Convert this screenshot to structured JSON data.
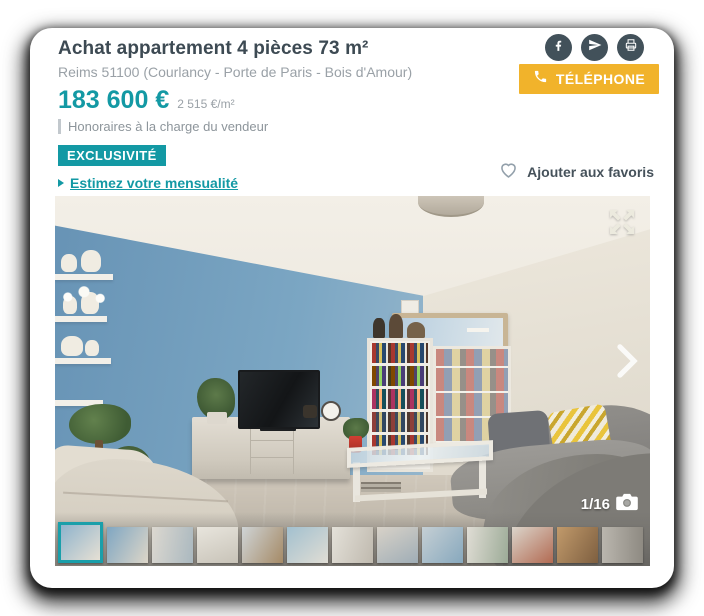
{
  "listing": {
    "title": "Achat appartement 4 pièces 73 m²",
    "location": "Reims 51100 (Courlancy - Porte de Paris - Bois d'Amour)",
    "price": "183 600 €",
    "price_per_sqm": "2 515 €/m²",
    "fees_note": "Honoraires à la charge du vendeur",
    "badge": "EXCLUSIVITÉ",
    "estimate_link": "Estimez votre mensualité",
    "phone_button": "TÉLÉPHONE",
    "favorite_label": "Ajouter aux favoris"
  },
  "share": {
    "icons": [
      "facebook",
      "send",
      "print"
    ]
  },
  "gallery": {
    "counter": "1/16",
    "selected_index": 0,
    "thumbnails": [
      {
        "angle": 135,
        "c1": "#8fb3cc",
        "c2": "#e6e0d4"
      },
      {
        "angle": 120,
        "c1": "#7fa6c2",
        "c2": "#ddd6c8"
      },
      {
        "angle": 100,
        "c1": "#dcd8d0",
        "c2": "#aab8bf"
      },
      {
        "angle": 160,
        "c1": "#e8e5dd",
        "c2": "#c8c3b8"
      },
      {
        "angle": 120,
        "c1": "#cfd4d6",
        "c2": "#a58a66"
      },
      {
        "angle": 140,
        "c1": "#a2c0cf",
        "c2": "#e0ddd4"
      },
      {
        "angle": 110,
        "c1": "#e4e1d9",
        "c2": "#bfb9ae"
      },
      {
        "angle": 150,
        "c1": "#d8d2c8",
        "c2": "#9fadb6"
      },
      {
        "angle": 130,
        "c1": "#c5cfd4",
        "c2": "#87a8bd"
      },
      {
        "angle": 100,
        "c1": "#e0ddd5",
        "c2": "#9cab97"
      },
      {
        "angle": 140,
        "c1": "#dbd5cb",
        "c2": "#b26a52"
      },
      {
        "angle": 120,
        "c1": "#c19a6b",
        "c2": "#7e5f40"
      },
      {
        "angle": 90,
        "c1": "#bab6ae",
        "c2": "#8e8a82"
      }
    ]
  },
  "colors": {
    "teal": "#1399a4",
    "yellow": "#f1b32b",
    "slate": "#42515a",
    "text_dark": "#3d4a53",
    "text_gray": "#9aa1a7"
  }
}
